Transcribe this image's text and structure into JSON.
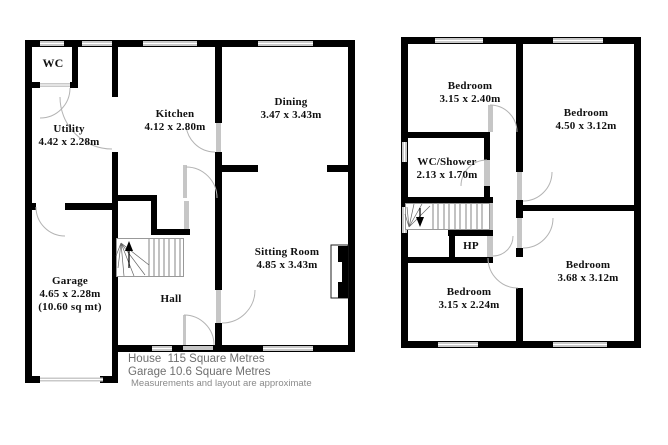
{
  "footer": {
    "house_area": "House  115 Square Metres",
    "garage_area": "Garage 10.6 Square Metres",
    "disclaimer": "Measurements and layout are approximate"
  },
  "ground_floor": {
    "wc": {
      "name": "WC"
    },
    "utility": {
      "name": "Utility",
      "dims": "4.42 x 2.28m"
    },
    "kitchen": {
      "name": "Kitchen",
      "dims": "4.12 x 2.80m"
    },
    "dining": {
      "name": "Dining",
      "dims": "3.47 x 3.43m"
    },
    "sitting": {
      "name": "Sitting Room",
      "dims": "4.85 x 3.43m"
    },
    "garage": {
      "name": "Garage",
      "dims": "4.65 x 2.28m",
      "area": "(10.60 sq mt)"
    },
    "hall": {
      "name": "Hall"
    }
  },
  "first_floor": {
    "bedroom_front_left": {
      "name": "Bedroom",
      "dims": "3.15 x 2.40m"
    },
    "bedroom_right": {
      "name": "Bedroom",
      "dims": "4.50 x 3.12m"
    },
    "wc_shower": {
      "name": "WC/Shower",
      "dims": "2.13 x 1.70m"
    },
    "hp": {
      "name": "HP"
    },
    "bedroom_back_left": {
      "name": "Bedroom",
      "dims": "3.15 x 2.24m"
    },
    "bedroom_back_right": {
      "name": "Bedroom",
      "dims": "3.68 x 3.12m"
    }
  },
  "colors": {
    "wall": "#000000",
    "window": "#c9c9c9",
    "door": "#c6c6c6",
    "arc": "#b3b3b3",
    "label": "#111111",
    "footer_text": "#6f6f6f"
  }
}
